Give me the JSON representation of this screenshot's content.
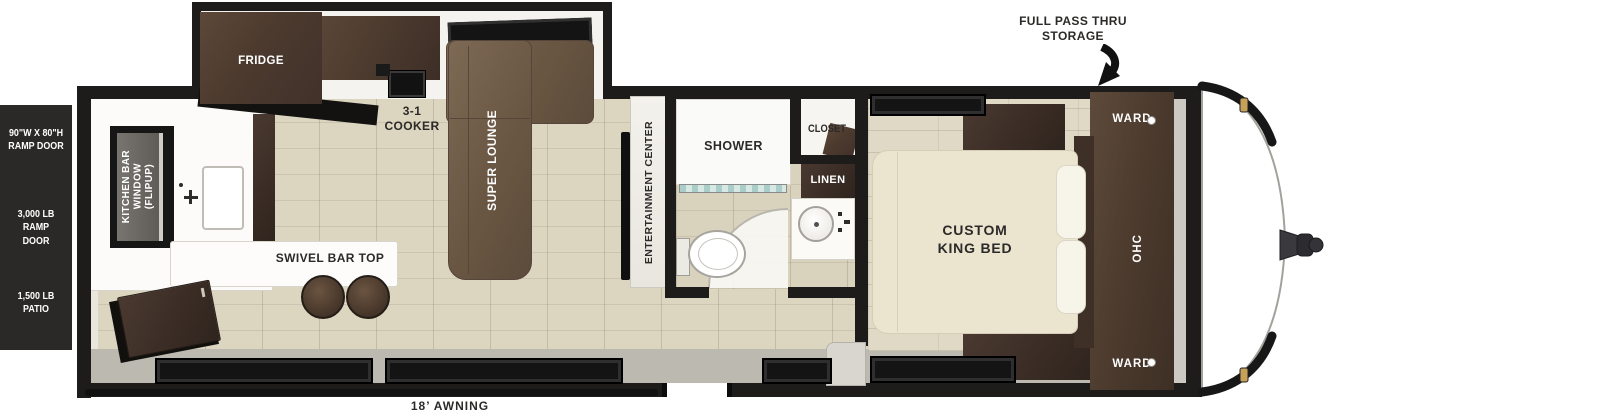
{
  "plan": {
    "left_panel": {
      "ramp_door_size": "90\"W X 80\"H\nRAMP DOOR",
      "ramp_rating": "3,000 LB RAMP\nDOOR",
      "patio_rating": "1,500 LB\nPATIO"
    },
    "kitchen": {
      "fridge": "FRIDGE",
      "cooker": "3-1\nCOOKER",
      "window": "KITCHEN BAR\nWINDOW\n(FLIPUP)",
      "bar": "SWIVEL BAR TOP"
    },
    "living": {
      "sofa": "SUPER LOUNGE",
      "entertainment": "ENTERTAINMENT CENTER"
    },
    "bath": {
      "shower": "SHOWER",
      "closet": "CLOSET",
      "linen": "LINEN"
    },
    "bedroom": {
      "bed": "CUSTOM\nKING BED",
      "ward_top": "WARD",
      "ohc": "OHC",
      "ward_bottom": "WARD"
    },
    "exterior": {
      "pass_thru": "FULL PASS THRU\nSTORAGE",
      "awning": "18’ AWNING"
    }
  },
  "colors": {
    "wall": "#1d1c1b",
    "panel": "#2a2927",
    "floor": "#dcd5c0",
    "wood": "#4c3a2e",
    "wood_dark": "#372a23",
    "sofa": "#6a5743",
    "bed": "#ebe4cf",
    "clearance_light_gold": "#c8a159",
    "shower_glass": "#a9cdc9",
    "window_glass": "#2f2f2f"
  }
}
